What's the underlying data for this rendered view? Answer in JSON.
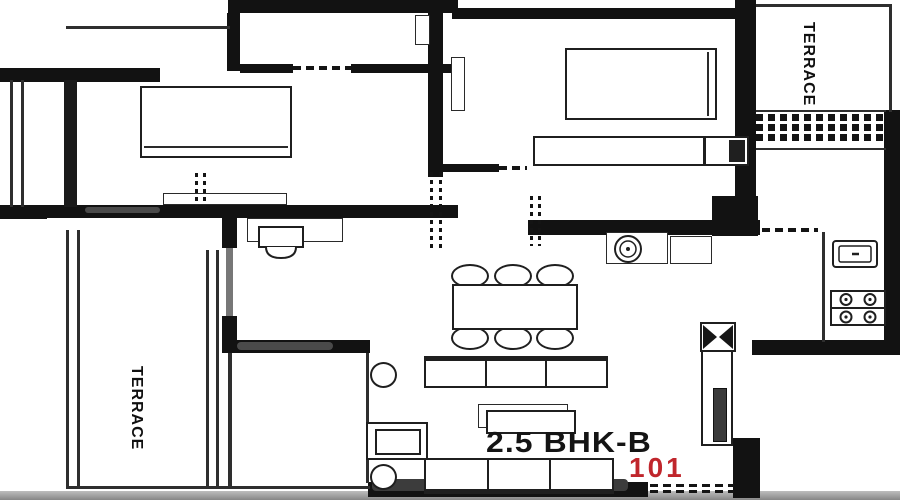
{
  "labels": {
    "unit_type": "2.5 BHK-B",
    "unit_number": "101",
    "terrace_top_right": "TERRACE",
    "terrace_bottom_left": "TERRACE"
  },
  "colors": {
    "wall": "#121212",
    "unit_number_red": "#c0262c",
    "background": "#ffffff",
    "thin_line": "#2e2e2e"
  },
  "furniture_icons": [
    "double-bed-icon",
    "double-bed-icon",
    "wardrobe-icon",
    "dressing-basin-icon",
    "dining-table-icon",
    "dining-chair-icon",
    "wash-basin-icon",
    "kitchen-sink-icon",
    "gas-stove-icon",
    "duct-shaft-icon",
    "sofa-icon",
    "center-table-icon",
    "side-table-icon",
    "stool-icon",
    "tv-unit-icon",
    "railing-hatch-icon"
  ]
}
